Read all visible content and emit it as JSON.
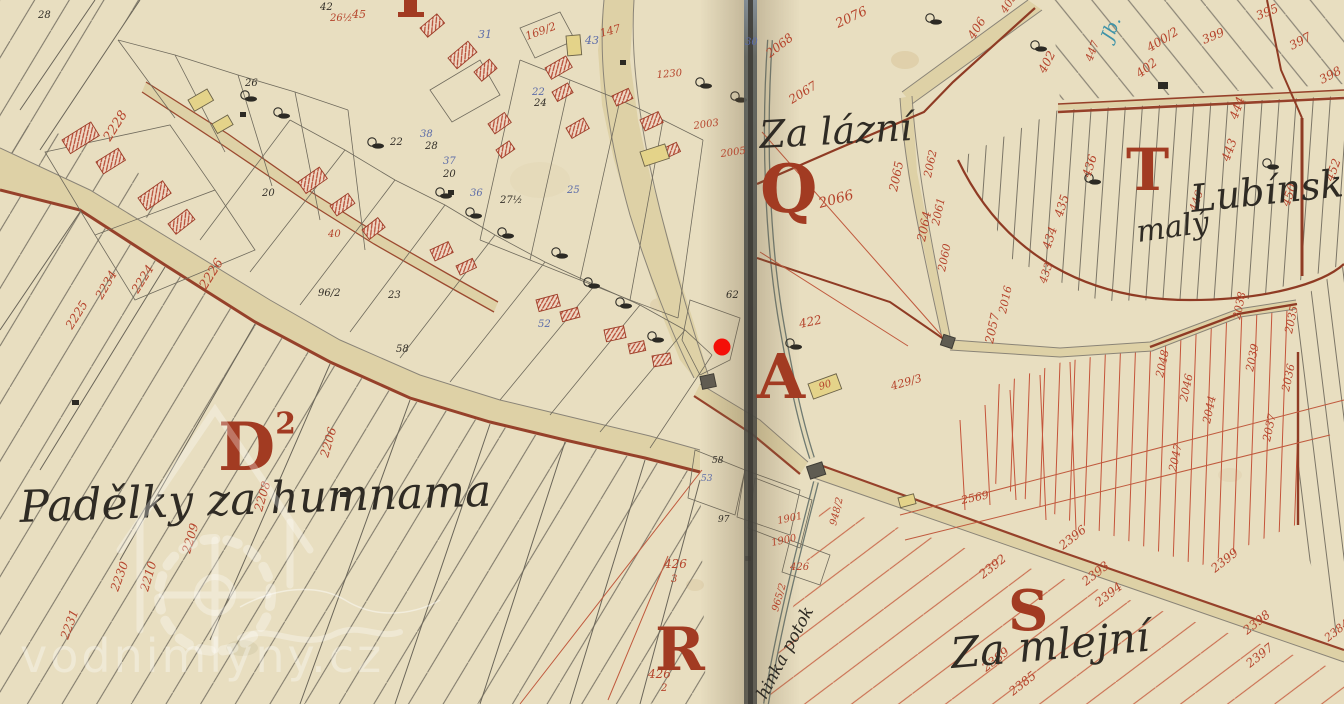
{
  "map": {
    "watermark": {
      "text": "vodnimlyny.cz"
    },
    "marker": {
      "x": 722,
      "y": 347,
      "r": 8.5,
      "color": "#f40f08"
    },
    "colors": {
      "paper": "#e8dec0",
      "road": "#ded1a6",
      "ink_red": "#b5432b",
      "ink_black": "#332f28",
      "ink_blue": "#5c6ca8",
      "letter_red": "#a23b22",
      "boundary_brown": "#8f3b24",
      "seam": "#4e4c44"
    },
    "place_names": [
      {
        "id": "za-lazni",
        "text": "Za lázní",
        "x": 760,
        "y": 148,
        "size": 38,
        "rot": -3
      },
      {
        "id": "padelky",
        "text": "Padělky za humnama",
        "x": 20,
        "y": 522,
        "size": 44,
        "rot": -2
      },
      {
        "id": "za-mlejni",
        "text": "Za mlejní",
        "x": 952,
        "y": 668,
        "size": 42,
        "rot": -5
      },
      {
        "id": "lubinsk",
        "text": "Lubínsk",
        "x": 1192,
        "y": 212,
        "size": 38,
        "rot": -6
      },
      {
        "id": "maly",
        "text": "malý",
        "x": 1138,
        "y": 242,
        "size": 30,
        "rot": -8
      },
      {
        "id": "potok",
        "text": "hinka potok",
        "x": 766,
        "y": 700,
        "size": 17,
        "rot": -62
      },
      {
        "id": "blue-note",
        "text": "Jb.",
        "x": 1112,
        "y": 42,
        "size": 18,
        "rot": -68,
        "color": "teal"
      }
    ],
    "section_letters": [
      {
        "t": "D",
        "sup": "2",
        "x": 218,
        "y": 470,
        "size": 66
      },
      {
        "t": "A",
        "x": 757,
        "y": 398,
        "size": 62
      },
      {
        "t": "Q",
        "x": 760,
        "y": 212,
        "size": 66
      },
      {
        "t": "R",
        "x": 655,
        "y": 670,
        "size": 60
      },
      {
        "t": "S",
        "x": 1008,
        "y": 630,
        "size": 56
      },
      {
        "t": "T",
        "x": 1126,
        "y": 190,
        "size": 58
      }
    ],
    "parcel_numbers": [
      {
        "t": "2228",
        "x": 110,
        "y": 142,
        "r": -58,
        "c": "r",
        "s": 13
      },
      {
        "t": "2226",
        "x": 206,
        "y": 290,
        "r": -58,
        "c": "r",
        "s": 13
      },
      {
        "t": "2224",
        "x": 138,
        "y": 294,
        "r": -58,
        "c": "r",
        "s": 12
      },
      {
        "t": "2225",
        "x": 72,
        "y": 330,
        "r": -58,
        "c": "r",
        "s": 12
      },
      {
        "t": "2234",
        "x": 102,
        "y": 300,
        "r": -60,
        "c": "r",
        "s": 12
      },
      {
        "t": "2206",
        "x": 328,
        "y": 458,
        "r": -74,
        "c": "r",
        "s": 12
      },
      {
        "t": "2208",
        "x": 262,
        "y": 512,
        "r": -74,
        "c": "r",
        "s": 12
      },
      {
        "t": "2209",
        "x": 190,
        "y": 554,
        "r": -74,
        "c": "r",
        "s": 12
      },
      {
        "t": "2210",
        "x": 148,
        "y": 592,
        "r": -74,
        "c": "r",
        "s": 12
      },
      {
        "t": "2230",
        "x": 118,
        "y": 592,
        "r": -70,
        "c": "r",
        "s": 12
      },
      {
        "t": "2231",
        "x": 68,
        "y": 640,
        "r": -70,
        "c": "r",
        "s": 12
      },
      {
        "t": "28",
        "x": 38,
        "y": 18,
        "r": 0,
        "c": "k",
        "s": 10
      },
      {
        "t": "26½",
        "x": 330,
        "y": 21,
        "r": 0,
        "c": "r",
        "s": 10
      },
      {
        "t": "42",
        "x": 320,
        "y": 10,
        "r": 0,
        "c": "k",
        "s": 10
      },
      {
        "t": "45",
        "x": 352,
        "y": 18,
        "r": 0,
        "c": "r",
        "s": 11
      },
      {
        "t": "31",
        "x": 478,
        "y": 38,
        "r": 0,
        "c": "b",
        "s": 11
      },
      {
        "t": "169/2",
        "x": 527,
        "y": 40,
        "r": -20,
        "c": "r",
        "s": 11
      },
      {
        "t": "43",
        "x": 585,
        "y": 44,
        "r": 0,
        "c": "b",
        "s": 11
      },
      {
        "t": "147",
        "x": 601,
        "y": 37,
        "r": -15,
        "c": "r",
        "s": 11
      },
      {
        "t": "38",
        "x": 420,
        "y": 137,
        "r": 0,
        "c": "b",
        "s": 10
      },
      {
        "t": "28",
        "x": 425,
        "y": 149,
        "r": 0,
        "c": "k",
        "s": 10
      },
      {
        "t": "22",
        "x": 532,
        "y": 95,
        "r": 0,
        "c": "b",
        "s": 10
      },
      {
        "t": "24",
        "x": 534,
        "y": 106,
        "r": 0,
        "c": "k",
        "s": 10
      },
      {
        "t": "20",
        "x": 443,
        "y": 177,
        "r": 0,
        "c": "k",
        "s": 10
      },
      {
        "t": "37",
        "x": 443,
        "y": 164,
        "r": 0,
        "c": "b",
        "s": 10
      },
      {
        "t": "36",
        "x": 470,
        "y": 196,
        "r": 0,
        "c": "b",
        "s": 10
      },
      {
        "t": "25",
        "x": 567,
        "y": 193,
        "r": 0,
        "c": "b",
        "s": 10
      },
      {
        "t": "27½",
        "x": 500,
        "y": 203,
        "r": 0,
        "c": "k",
        "s": 10
      },
      {
        "t": "30",
        "x": 745,
        "y": 45,
        "r": 0,
        "c": "b",
        "s": 10
      },
      {
        "t": "62",
        "x": 726,
        "y": 298,
        "r": 0,
        "c": "k",
        "s": 10
      },
      {
        "t": "96/2",
        "x": 318,
        "y": 296,
        "r": 0,
        "c": "k",
        "s": 10
      },
      {
        "t": "52",
        "x": 538,
        "y": 327,
        "r": 0,
        "c": "b",
        "s": 10
      },
      {
        "t": "58",
        "x": 396,
        "y": 352,
        "r": 0,
        "c": "k",
        "s": 10
      },
      {
        "t": "23",
        "x": 388,
        "y": 298,
        "r": 0,
        "c": "k",
        "s": 10
      },
      {
        "t": "22",
        "x": 390,
        "y": 145,
        "r": 0,
        "c": "k",
        "s": 10
      },
      {
        "t": "26",
        "x": 245,
        "y": 86,
        "r": 0,
        "c": "k",
        "s": 10
      },
      {
        "t": "20",
        "x": 262,
        "y": 196,
        "r": 0,
        "c": "k",
        "s": 10
      },
      {
        "t": "40",
        "x": 328,
        "y": 237,
        "r": 0,
        "c": "r",
        "s": 10
      },
      {
        "t": "2003",
        "x": 694,
        "y": 129,
        "r": -8,
        "c": "r",
        "s": 10
      },
      {
        "t": "2005",
        "x": 721,
        "y": 157,
        "r": -8,
        "c": "r",
        "s": 10
      },
      {
        "t": "1230",
        "x": 657,
        "y": 78,
        "r": -5,
        "c": "r",
        "s": 10
      },
      {
        "t": "58",
        "x": 712,
        "y": 463,
        "r": 0,
        "c": "k",
        "s": 9
      },
      {
        "t": "97",
        "x": 718,
        "y": 522,
        "r": 0,
        "c": "k",
        "s": 9
      },
      {
        "t": "53",
        "x": 701,
        "y": 481,
        "r": 0,
        "c": "b",
        "s": 9
      },
      {
        "t": "1901",
        "x": 778,
        "y": 524,
        "r": -12,
        "c": "r",
        "s": 10
      },
      {
        "t": "1900",
        "x": 772,
        "y": 546,
        "r": -12,
        "c": "r",
        "s": 10
      },
      {
        "t": "426",
        "x": 790,
        "y": 570,
        "r": 0,
        "c": "r",
        "s": 10
      },
      {
        "t": "948/2",
        "x": 836,
        "y": 526,
        "r": -76,
        "c": "r",
        "s": 10
      },
      {
        "t": "965/2",
        "x": 778,
        "y": 612,
        "r": -74,
        "c": "r",
        "s": 10
      },
      {
        "t": "426",
        "x": 664,
        "y": 568,
        "r": 0,
        "c": "r",
        "s": 12
      },
      {
        "t": "3",
        "x": 671,
        "y": 582,
        "r": 0,
        "c": "r",
        "s": 10
      },
      {
        "t": "426",
        "x": 648,
        "y": 678,
        "r": 0,
        "c": "r",
        "s": 12
      },
      {
        "t": "2",
        "x": 661,
        "y": 691,
        "r": 0,
        "c": "r",
        "s": 10
      },
      {
        "t": "90",
        "x": 820,
        "y": 390,
        "r": -18,
        "c": "r",
        "s": 10
      },
      {
        "t": "2076",
        "x": 838,
        "y": 28,
        "r": -25,
        "c": "r",
        "s": 13
      },
      {
        "t": "2068",
        "x": 770,
        "y": 58,
        "r": -38,
        "c": "r",
        "s": 12
      },
      {
        "t": "2067",
        "x": 792,
        "y": 104,
        "r": -32,
        "c": "r",
        "s": 12
      },
      {
        "t": "2066",
        "x": 820,
        "y": 208,
        "r": -15,
        "c": "r",
        "s": 14
      },
      {
        "t": "2065",
        "x": 897,
        "y": 192,
        "r": -78,
        "c": "r",
        "s": 12
      },
      {
        "t": "2064",
        "x": 925,
        "y": 242,
        "r": -78,
        "c": "r",
        "s": 12
      },
      {
        "t": "2062",
        "x": 931,
        "y": 178,
        "r": -78,
        "c": "r",
        "s": 11
      },
      {
        "t": "2061",
        "x": 939,
        "y": 226,
        "r": -78,
        "c": "r",
        "s": 11
      },
      {
        "t": "2060",
        "x": 945,
        "y": 272,
        "r": -78,
        "c": "r",
        "s": 11
      },
      {
        "t": "406",
        "x": 974,
        "y": 40,
        "r": -58,
        "c": "r",
        "s": 12
      },
      {
        "t": "405",
        "x": 1006,
        "y": 14,
        "r": -58,
        "c": "r",
        "s": 11
      },
      {
        "t": "402",
        "x": 1045,
        "y": 74,
        "r": -62,
        "c": "r",
        "s": 12
      },
      {
        "t": "422",
        "x": 800,
        "y": 328,
        "r": -12,
        "c": "r",
        "s": 12
      },
      {
        "t": "429/3",
        "x": 892,
        "y": 390,
        "r": -16,
        "c": "r",
        "s": 11
      },
      {
        "t": "2057",
        "x": 993,
        "y": 344,
        "r": -78,
        "c": "r",
        "s": 12
      },
      {
        "t": "2016",
        "x": 1006,
        "y": 314,
        "r": -78,
        "c": "r",
        "s": 11
      },
      {
        "t": "2569",
        "x": 962,
        "y": 504,
        "r": -12,
        "c": "r",
        "s": 11
      },
      {
        "t": "395",
        "x": 1258,
        "y": 20,
        "r": -22,
        "c": "r",
        "s": 12
      },
      {
        "t": "399",
        "x": 1204,
        "y": 44,
        "r": -22,
        "c": "r",
        "s": 12
      },
      {
        "t": "400/2",
        "x": 1150,
        "y": 52,
        "r": -32,
        "c": "r",
        "s": 12
      },
      {
        "t": "402",
        "x": 1140,
        "y": 78,
        "r": -38,
        "c": "r",
        "s": 12
      },
      {
        "t": "397",
        "x": 1292,
        "y": 50,
        "r": -28,
        "c": "r",
        "s": 12
      },
      {
        "t": "398",
        "x": 1322,
        "y": 84,
        "r": -28,
        "c": "r",
        "s": 12
      },
      {
        "t": "447",
        "x": 1092,
        "y": 62,
        "r": -70,
        "c": "r",
        "s": 11
      },
      {
        "t": "444",
        "x": 1237,
        "y": 120,
        "r": -70,
        "c": "r",
        "s": 12
      },
      {
        "t": "443",
        "x": 1229,
        "y": 162,
        "r": -70,
        "c": "r",
        "s": 12
      },
      {
        "t": "436",
        "x": 1090,
        "y": 178,
        "r": -72,
        "c": "r",
        "s": 12
      },
      {
        "t": "435",
        "x": 1062,
        "y": 218,
        "r": -72,
        "c": "r",
        "s": 12
      },
      {
        "t": "434",
        "x": 1050,
        "y": 250,
        "r": -72,
        "c": "r",
        "s": 12
      },
      {
        "t": "433",
        "x": 1046,
        "y": 284,
        "r": -72,
        "c": "r",
        "s": 11
      },
      {
        "t": "450",
        "x": 1289,
        "y": 207,
        "r": -70,
        "c": "r",
        "s": 12
      },
      {
        "t": "452",
        "x": 1333,
        "y": 182,
        "r": -70,
        "c": "r",
        "s": 12
      },
      {
        "t": "446",
        "x": 1196,
        "y": 212,
        "r": -70,
        "c": "r",
        "s": 11
      },
      {
        "t": "2048",
        "x": 1163,
        "y": 378,
        "r": -78,
        "c": "r",
        "s": 11
      },
      {
        "t": "2046",
        "x": 1187,
        "y": 402,
        "r": -78,
        "c": "r",
        "s": 11
      },
      {
        "t": "2047",
        "x": 1176,
        "y": 472,
        "r": -78,
        "c": "r",
        "s": 11
      },
      {
        "t": "2044",
        "x": 1210,
        "y": 424,
        "r": -78,
        "c": "r",
        "s": 11
      },
      {
        "t": "2039",
        "x": 1253,
        "y": 372,
        "r": -78,
        "c": "r",
        "s": 11
      },
      {
        "t": "2037",
        "x": 1270,
        "y": 442,
        "r": -78,
        "c": "r",
        "s": 11
      },
      {
        "t": "2036",
        "x": 1289,
        "y": 392,
        "r": -78,
        "c": "r",
        "s": 11
      },
      {
        "t": "2035",
        "x": 1292,
        "y": 334,
        "r": -78,
        "c": "r",
        "s": 11
      },
      {
        "t": "2038",
        "x": 1240,
        "y": 320,
        "r": -78,
        "c": "r",
        "s": 11
      },
      {
        "t": "2396",
        "x": 1063,
        "y": 550,
        "r": -38,
        "c": "r",
        "s": 12
      },
      {
        "t": "2393",
        "x": 1086,
        "y": 586,
        "r": -38,
        "c": "r",
        "s": 12
      },
      {
        "t": "2394",
        "x": 1099,
        "y": 607,
        "r": -38,
        "c": "r",
        "s": 12
      },
      {
        "t": "2392",
        "x": 983,
        "y": 579,
        "r": -38,
        "c": "r",
        "s": 12
      },
      {
        "t": "2389",
        "x": 986,
        "y": 672,
        "r": -38,
        "c": "r",
        "s": 12
      },
      {
        "t": "2385",
        "x": 1013,
        "y": 696,
        "r": -38,
        "c": "r",
        "s": 12
      },
      {
        "t": "2399",
        "x": 1215,
        "y": 573,
        "r": -38,
        "c": "r",
        "s": 12
      },
      {
        "t": "2398",
        "x": 1247,
        "y": 635,
        "r": -38,
        "c": "r",
        "s": 12
      },
      {
        "t": "2397",
        "x": 1250,
        "y": 668,
        "r": -38,
        "c": "r",
        "s": 12
      },
      {
        "t": "2384",
        "x": 1328,
        "y": 642,
        "r": -38,
        "c": "r",
        "s": 11
      }
    ]
  }
}
